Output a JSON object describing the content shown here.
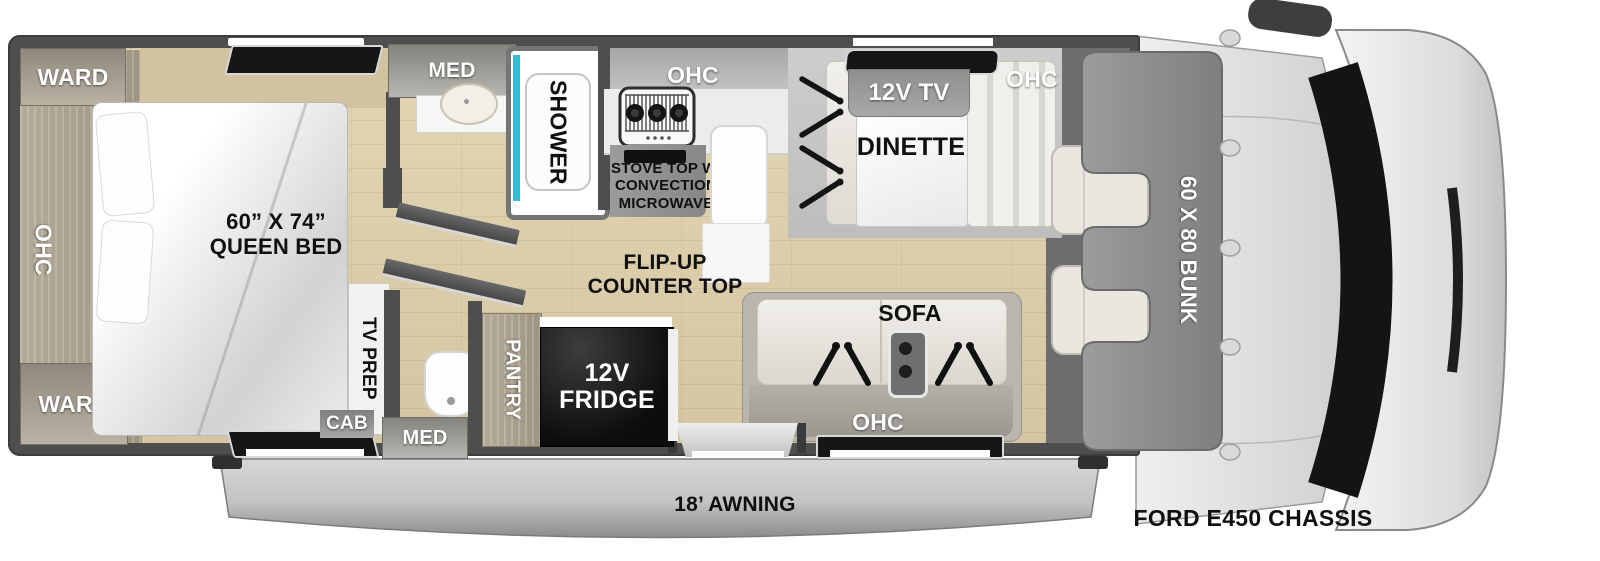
{
  "labels": {
    "ward_top": "WARD",
    "ward_bottom": "WARD",
    "ohc_bedroom": "OHC",
    "bed_size": "60” X 74”",
    "bed_type": "QUEEN BED",
    "tv_prep": "TV PREP",
    "cab": "CAB",
    "med_top": "MED",
    "med_bottom": "MED",
    "shower": "SHOWER",
    "ohc_kitchen": "OHC",
    "stove_1": "STOVE TOP W/",
    "stove_2": "CONVECTION",
    "stove_3": "MICROWAVE",
    "flip_1": "FLIP-UP",
    "flip_2": "COUNTER TOP",
    "pantry": "PANTRY",
    "fridge_1": "12V",
    "fridge_2": "FRIDGE",
    "tv": "12V TV",
    "dinette": "DINETTE",
    "ohc_dinette": "OHC",
    "sofa": "SOFA",
    "ohc_sofa": "OHC",
    "bunk": "60 X 80 BUNK",
    "awning": "18’ AWNING",
    "chassis": "FORD E450 CHASSIS"
  },
  "colors": {
    "wall": "#4e4e4e",
    "floor1": "#e3d6b4",
    "floor2": "#d5c6a1",
    "accent": "#33bcd8",
    "window": "#161616",
    "bunk": "#8f8f8f",
    "fridge": "#0d0d0d",
    "awn1": "#d4d4d4",
    "awn2": "#8e8e8e"
  }
}
